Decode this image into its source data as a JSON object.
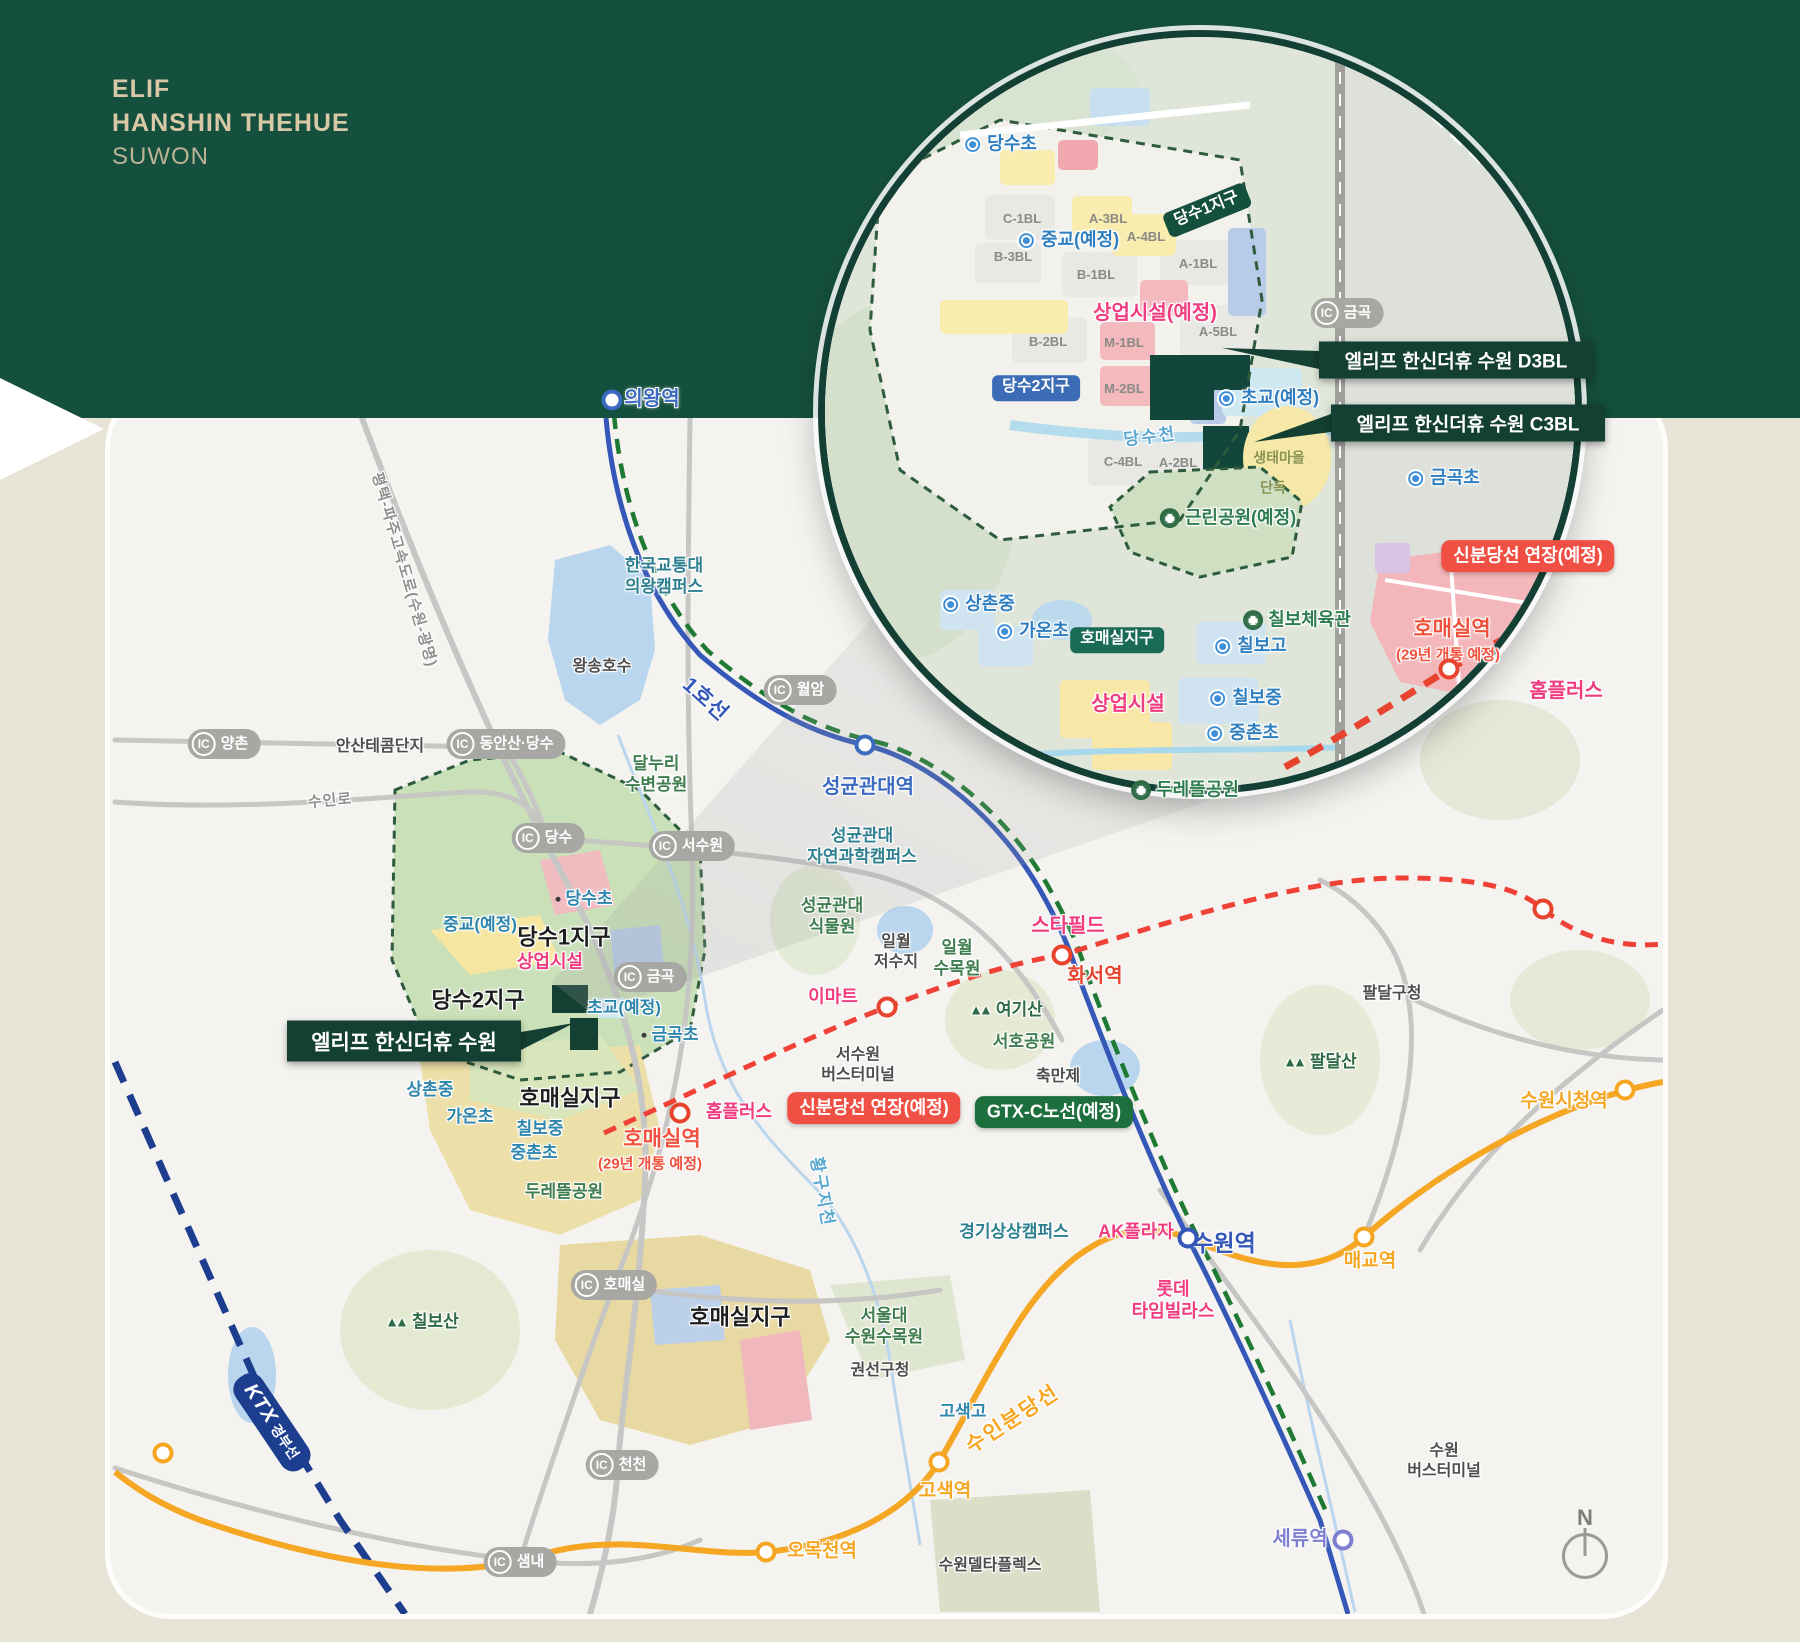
{
  "header": {
    "line1": "ELIF",
    "line2": "HANSHIN THEHUE",
    "line3": "SUWON"
  },
  "colors": {
    "header_bg": "#15503e",
    "page_bg": "#e7e3d6",
    "title_text": "#d9c8a6",
    "line1_blue": "#3558b8",
    "gtx_green": "#1e7a33",
    "suin_bundang_orange": "#f5a623",
    "shinbundang_red": "#ef4136",
    "ktx_navy": "#1d3d8f",
    "badge_red": "#f05044",
    "badge_green": "#1e6f3e",
    "callout_green": "#143f33",
    "school_blue": "#2f7fc0",
    "park_green": "#2e7d4e",
    "commercial_pink": "#ef3d7f"
  },
  "icons": {
    "ic_prefix": "IC",
    "compass_label": "N"
  },
  "callouts": [
    {
      "t": "엘리프 한신더휴 수원 D3BL",
      "x": 1456,
      "y": 360,
      "w": 274,
      "h": 37,
      "fs": 19,
      "tipx": 1222,
      "tipy": 348,
      "layer": "inset"
    },
    {
      "t": "엘리프 한신더휴 수원 C3BL",
      "x": 1468,
      "y": 423,
      "w": 274,
      "h": 37,
      "fs": 19,
      "tipx": 1254,
      "tipy": 442,
      "layer": "inset"
    },
    {
      "t": "엘리프 한신더휴 수원",
      "x": 404,
      "y": 1041,
      "w": 234,
      "h": 41,
      "fs": 21,
      "tipx": 574,
      "tipy": 1023,
      "layer": "map"
    }
  ],
  "inset": {
    "labels": [
      {
        "t": "당수초",
        "k": "school",
        "icon": "drop",
        "x": 1000,
        "y": 144
      },
      {
        "t": "C-1BL",
        "k": "block",
        "x": 1022,
        "y": 218
      },
      {
        "t": "A-3BL",
        "k": "block",
        "x": 1108,
        "y": 218
      },
      {
        "t": "B-3BL",
        "k": "block",
        "x": 1013,
        "y": 256
      },
      {
        "t": "A-4BL",
        "k": "block",
        "x": 1146,
        "y": 236
      },
      {
        "t": "B-1BL",
        "k": "block",
        "x": 1096,
        "y": 274
      },
      {
        "t": "A-1BL",
        "k": "block",
        "x": 1198,
        "y": 263
      },
      {
        "t": "B-2BL",
        "k": "block",
        "x": 1048,
        "y": 341
      },
      {
        "t": "M-1BL",
        "k": "block",
        "x": 1124,
        "y": 342
      },
      {
        "t": "A-5BL",
        "k": "block",
        "x": 1218,
        "y": 331
      },
      {
        "t": "M-2BL",
        "k": "block",
        "x": 1124,
        "y": 388
      },
      {
        "t": "C-4BL",
        "k": "block",
        "x": 1123,
        "y": 461
      },
      {
        "t": "A-2BL",
        "k": "block",
        "x": 1178,
        "y": 462
      },
      {
        "t": "중교(예정)",
        "k": "school",
        "icon": "drop",
        "x": 1068,
        "y": 240
      },
      {
        "t": "상업시설(예정)",
        "k": "commercial-bold",
        "x": 1155,
        "y": 314
      },
      {
        "t": "당수1지구",
        "k": "badge-dgreen",
        "x": 1207,
        "y": 210,
        "r": -22
      },
      {
        "t": "당수2지구",
        "k": "badge-blue",
        "x": 1036,
        "y": 388
      },
      {
        "t": "금곡",
        "k": "ic",
        "x": 1347,
        "y": 313
      },
      {
        "t": "초교(예정)",
        "k": "school",
        "icon": "drop",
        "x": 1268,
        "y": 398
      },
      {
        "t": "당수천",
        "k": "river",
        "x": 1150,
        "y": 437,
        "r": -7
      },
      {
        "t": "생태마을",
        "k": "village",
        "x": 1279,
        "y": 457
      },
      {
        "t": "단독",
        "k": "village",
        "x": 1273,
        "y": 487
      },
      {
        "t": "금곡초",
        "k": "school",
        "icon": "drop",
        "x": 1443,
        "y": 478
      },
      {
        "t": "근린공원(예정)",
        "k": "park",
        "icon": "tree",
        "x": 1228,
        "y": 518
      },
      {
        "t": "신분당선 연장(예정)",
        "k": "badge-red",
        "x": 1528,
        "y": 556
      },
      {
        "t": "상촌중",
        "k": "school",
        "icon": "drop",
        "x": 978,
        "y": 604
      },
      {
        "t": "가온초",
        "k": "school",
        "icon": "drop",
        "x": 1032,
        "y": 631
      },
      {
        "t": "호매실지구",
        "k": "badge-teal",
        "x": 1117,
        "y": 640
      },
      {
        "t": "칠보체육관",
        "k": "park",
        "icon": "tree",
        "x": 1297,
        "y": 620
      },
      {
        "t": "칠보고",
        "k": "school",
        "icon": "drop",
        "x": 1250,
        "y": 646
      },
      {
        "t": "상업시설",
        "k": "commercial-bold",
        "x": 1128,
        "y": 705
      },
      {
        "t": "칠보중",
        "k": "school",
        "icon": "drop",
        "x": 1245,
        "y": 698
      },
      {
        "t": "중촌초",
        "k": "school",
        "icon": "drop",
        "x": 1242,
        "y": 733
      },
      {
        "t": "두레뜰공원",
        "k": "park",
        "icon": "tree",
        "x": 1185,
        "y": 790
      },
      {
        "t": "호매실역",
        "k": "station-red-bold",
        "x": 1452,
        "y": 630
      },
      {
        "t": "(29년 개통 예정)",
        "k": "station-red-small",
        "x": 1448,
        "y": 655
      },
      {
        "t": "홈플러스",
        "k": "commercial-bold",
        "x": 1566,
        "y": 692
      }
    ],
    "stations": [
      {
        "x": 1449,
        "y": 669,
        "c": "#e8432e"
      }
    ]
  },
  "map": {
    "labels": [
      {
        "t": "의왕역",
        "k": "station-blue",
        "x": 652,
        "y": 400
      },
      {
        "t": "평택-파주고속도로(수원-광명)",
        "k": "road-label",
        "x": 404,
        "y": 570,
        "r": 74
      },
      {
        "t": "한국교통대\n의왕캠퍼스",
        "k": "campus",
        "x": 664,
        "y": 576
      },
      {
        "t": "왕송호수",
        "k": "place-dark",
        "x": 602,
        "y": 668
      },
      {
        "t": "1호선",
        "k": "line-1",
        "x": 705,
        "y": 700,
        "r": 42
      },
      {
        "t": "월암",
        "k": "ic",
        "x": 800,
        "y": 690
      },
      {
        "t": "안산테콤단지",
        "k": "place-dark",
        "x": 380,
        "y": 748
      },
      {
        "t": "양촌",
        "k": "ic",
        "x": 224,
        "y": 744
      },
      {
        "t": "동안산·당수",
        "k": "ic",
        "x": 506,
        "y": 744
      },
      {
        "t": "수인로",
        "k": "road-label",
        "x": 330,
        "y": 801,
        "r": -5
      },
      {
        "t": "달누리\n수변공원",
        "k": "park-2l",
        "x": 656,
        "y": 774
      },
      {
        "t": "당수",
        "k": "ic",
        "x": 548,
        "y": 838
      },
      {
        "t": "서수원",
        "k": "ic",
        "x": 692,
        "y": 846
      },
      {
        "t": "성균관대역",
        "k": "station-blue",
        "x": 868,
        "y": 788
      },
      {
        "t": "성균관대\n자연과학캠퍼스",
        "k": "campus",
        "x": 862,
        "y": 846
      },
      {
        "t": "성균관대\n식물원",
        "k": "park-2l",
        "x": 832,
        "y": 916
      },
      {
        "t": "일월\n저수지",
        "k": "place-dark",
        "x": 896,
        "y": 953
      },
      {
        "t": "일월\n수목원",
        "k": "park-2l",
        "x": 957,
        "y": 958
      },
      {
        "t": "스타필드",
        "k": "commercial-bold",
        "x": 1068,
        "y": 927
      },
      {
        "t": "화서역",
        "k": "station-red",
        "x": 1095,
        "y": 977
      },
      {
        "t": "이마트",
        "k": "commercial",
        "x": 833,
        "y": 997
      },
      {
        "t": "서수원\n버스터미널",
        "k": "place-dark",
        "x": 858,
        "y": 1066
      },
      {
        "t": "여기산",
        "k": "mountain",
        "icon": "mtn",
        "x": 1006,
        "y": 1010
      },
      {
        "t": "서호공원",
        "k": "park-plain",
        "x": 1024,
        "y": 1042
      },
      {
        "t": "축만제",
        "k": "place-dark",
        "x": 1058,
        "y": 1078
      },
      {
        "t": "신분당선 연장(예정)",
        "k": "badge-red",
        "x": 874,
        "y": 1108
      },
      {
        "t": "GTX-C노선(예정)",
        "k": "badge-green",
        "x": 1054,
        "y": 1112
      },
      {
        "t": "팔달구청",
        "k": "place-dark",
        "x": 1392,
        "y": 995
      },
      {
        "t": "팔달산",
        "k": "mountain",
        "icon": "mtn",
        "x": 1320,
        "y": 1062
      },
      {
        "t": "당수초",
        "k": "school-dot",
        "icon": "dot",
        "x": 584,
        "y": 899
      },
      {
        "t": "중교(예정)",
        "k": "school-dot",
        "x": 480,
        "y": 925
      },
      {
        "t": "당수1지구",
        "k": "district",
        "x": 564,
        "y": 937
      },
      {
        "t": "상업시설",
        "k": "commercial",
        "x": 550,
        "y": 962
      },
      {
        "t": "당수2지구",
        "k": "district",
        "x": 478,
        "y": 1000
      },
      {
        "t": "초교(예정)",
        "k": "school-dot",
        "x": 624,
        "y": 1008
      },
      {
        "t": "금곡",
        "k": "ic",
        "x": 650,
        "y": 977
      },
      {
        "t": "금곡초",
        "k": "school-dot",
        "icon": "dot",
        "x": 670,
        "y": 1035
      },
      {
        "t": "상촌중",
        "k": "school-dot",
        "x": 430,
        "y": 1090
      },
      {
        "t": "가온초",
        "k": "school-dot",
        "x": 470,
        "y": 1117
      },
      {
        "t": "호매실지구",
        "k": "district",
        "x": 570,
        "y": 1098
      },
      {
        "t": "칠보중",
        "k": "school-dot",
        "x": 540,
        "y": 1129
      },
      {
        "t": "중촌초",
        "k": "school-dot",
        "x": 534,
        "y": 1153
      },
      {
        "t": "두레뜰공원",
        "k": "park-plain",
        "x": 564,
        "y": 1192
      },
      {
        "t": "호매실역",
        "k": "station-red-bold",
        "x": 662,
        "y": 1140
      },
      {
        "t": "(29년 개통 예정)",
        "k": "station-red-small",
        "x": 650,
        "y": 1164
      },
      {
        "t": "홈플러스",
        "k": "commercial",
        "x": 739,
        "y": 1112
      },
      {
        "t": "황구지천",
        "k": "river",
        "x": 822,
        "y": 1192,
        "r": 80
      },
      {
        "t": "경기상상캠퍼스",
        "k": "campus",
        "x": 1014,
        "y": 1232
      },
      {
        "t": "AK플라자",
        "k": "commercial",
        "x": 1136,
        "y": 1232
      },
      {
        "t": "수원역",
        "k": "station-blue-bold",
        "x": 1224,
        "y": 1243
      },
      {
        "t": "롯데\n타임빌라스",
        "k": "commercial-2l",
        "x": 1173,
        "y": 1300
      },
      {
        "t": "매교역",
        "k": "station-orange",
        "x": 1370,
        "y": 1262
      },
      {
        "t": "수원시청역",
        "k": "station-orange",
        "x": 1564,
        "y": 1102
      },
      {
        "t": "호매실",
        "k": "ic",
        "x": 614,
        "y": 1285
      },
      {
        "t": "호매실지구",
        "k": "district",
        "x": 740,
        "y": 1317
      },
      {
        "t": "칠보산",
        "k": "mountain",
        "icon": "mtn",
        "x": 422,
        "y": 1322
      },
      {
        "t": "서울대\n수원수목원",
        "k": "park-2l",
        "x": 884,
        "y": 1326
      },
      {
        "t": "권선구청",
        "k": "place-dark",
        "x": 880,
        "y": 1372
      },
      {
        "t": "고색고",
        "k": "school-dot",
        "x": 963,
        "y": 1412
      },
      {
        "t": "수인분당선",
        "k": "line-orange",
        "x": 1013,
        "y": 1420,
        "r": -33
      },
      {
        "t": "고색역",
        "k": "station-orange",
        "x": 945,
        "y": 1492
      },
      {
        "t": "오목천역",
        "k": "station-orange",
        "x": 822,
        "y": 1552
      },
      {
        "t": "수원델타플렉스",
        "k": "place-dark",
        "x": 990,
        "y": 1567
      },
      {
        "t": "천천",
        "k": "ic",
        "x": 622,
        "y": 1465
      },
      {
        "t": "샘내",
        "k": "ic",
        "x": 520,
        "y": 1562
      },
      {
        "t": "세류역",
        "k": "station-lav",
        "x": 1300,
        "y": 1540
      },
      {
        "t": "수원\n버스터미널",
        "k": "place-dark",
        "x": 1444,
        "y": 1462
      },
      {
        "t": "KTX 경부선",
        "k": "ktx",
        "x": 272,
        "y": 1422,
        "r": 56
      }
    ],
    "stations": [
      {
        "x": 612,
        "y": 400,
        "c": "#3b6ac0"
      },
      {
        "x": 865,
        "y": 745,
        "c": "#3b6ac0"
      },
      {
        "x": 1188,
        "y": 1238,
        "c": "#3558b8"
      },
      {
        "x": 1343,
        "y": 1540,
        "c": "#7f7fd0"
      },
      {
        "x": 1364,
        "y": 1237,
        "c": "#f5a623"
      },
      {
        "x": 1625,
        "y": 1090,
        "c": "#f5a623"
      },
      {
        "x": 939,
        "y": 1462,
        "c": "#f5a623"
      },
      {
        "x": 766,
        "y": 1552,
        "c": "#f5a623"
      },
      {
        "x": 163,
        "y": 1453,
        "c": "#f5a623"
      },
      {
        "x": 680,
        "y": 1113,
        "c": "#e8432e"
      },
      {
        "x": 887,
        "y": 1007,
        "c": "#e8432e"
      },
      {
        "x": 1062,
        "y": 955,
        "c": "#e8432e"
      },
      {
        "x": 1543,
        "y": 909,
        "c": "#e8432e"
      }
    ]
  }
}
